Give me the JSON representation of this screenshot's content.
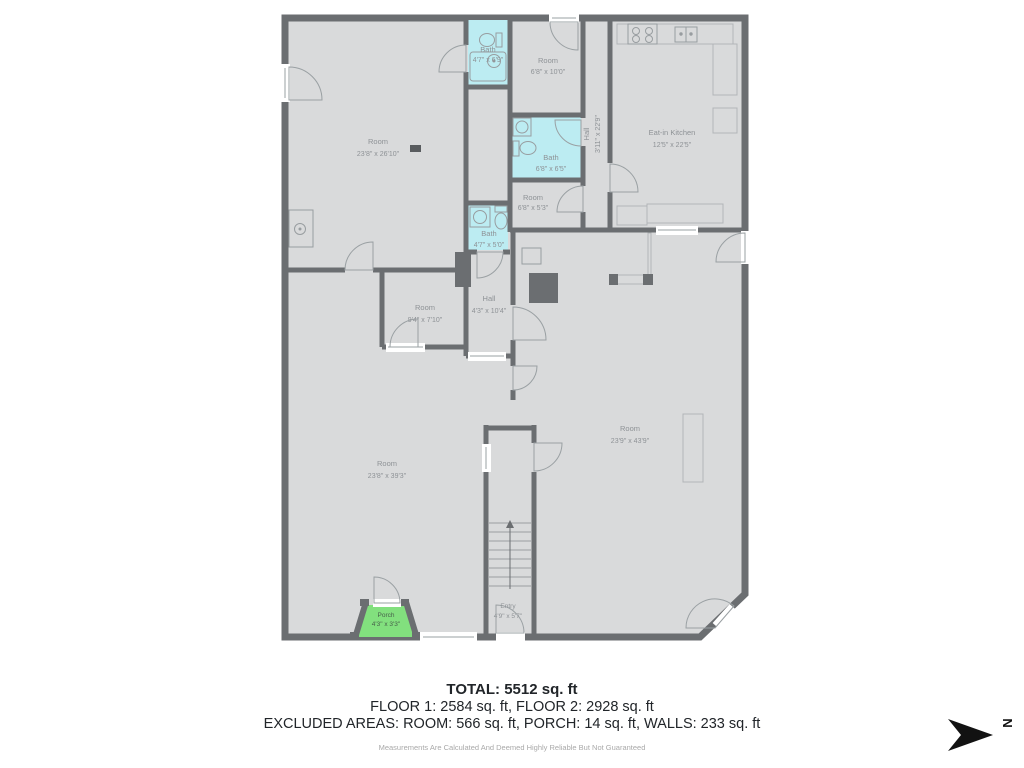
{
  "rooms": {
    "room_main_upper": {
      "name": "Room",
      "dims": "23'8\" x 26'10\""
    },
    "bath_top": {
      "name": "Bath",
      "dims": "4'7\" x 6'9\""
    },
    "room_6x10": {
      "name": "Room",
      "dims": "6'8\" x 10'0\""
    },
    "bath_mid": {
      "name": "Bath",
      "dims": "6'8\" x 6'5\""
    },
    "room_6x5": {
      "name": "Room",
      "dims": "6'8\" x 5'3\""
    },
    "bath_small": {
      "name": "Bath",
      "dims": "4'7\" x 5'0\""
    },
    "hall_upper": {
      "name": "Hall",
      "dims": "3'11\" x 22'9\""
    },
    "kitchen": {
      "name": "Eat-in Kitchen",
      "dims": "12'5\" x 22'5\""
    },
    "room_9x7": {
      "name": "Room",
      "dims": "9'4\" x 7'10\""
    },
    "hall_lower": {
      "name": "Hall",
      "dims": "4'3\" x 10'4\""
    },
    "room_right": {
      "name": "Room",
      "dims": "23'9\" x 43'9\""
    },
    "room_left": {
      "name": "Room",
      "dims": "23'8\" x 39'3\""
    },
    "entry": {
      "name": "Entry",
      "dims": "4'9\" x 5'7\""
    },
    "porch": {
      "name": "Porch",
      "dims": "4'3\" x 3'3\""
    }
  },
  "summary": {
    "total": "TOTAL: 5512 sq. ft",
    "floors": "FLOOR 1: 2584 sq. ft, FLOOR 2: 2928 sq. ft",
    "excluded": "EXCLUDED AREAS: ROOM: 566 sq. ft, PORCH: 14 sq. ft, WALLS: 233 sq. ft",
    "disclaimer": "Measurements Are Calculated And Deemed Highly Reliable But Not Guaranteed"
  },
  "compass": {
    "direction": "N"
  },
  "colors": {
    "wall": "#6b6e71",
    "floor": "#d9dadb",
    "bath": "#bcecf2",
    "porch": "#82e07e"
  }
}
